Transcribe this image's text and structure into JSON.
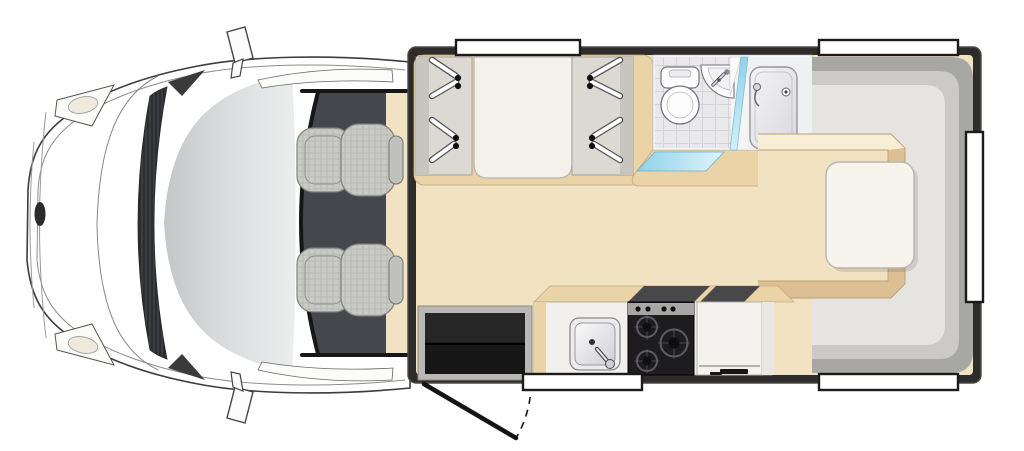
{
  "meta": {
    "description": "Top-down floor plan illustration of a motorhome (van cab at left, habitation area at right)",
    "view": "plan-view",
    "background": "#ffffff"
  },
  "colors": {
    "wall": "#2d2c2a",
    "wall_edge": "#4a4a48",
    "floor": "#f1e2c1",
    "bevel_light": "#f8eed5",
    "bevel_mid": "#e9d3a7",
    "bevel_dark": "#dcbf92",
    "cab_floor": "#45474c",
    "body": "#ffffff",
    "seat": "#c9c9c5",
    "headrest": "#c0c0bd",
    "lounge_back": "#a7a7a5",
    "lounge_mid": "#cbcac6",
    "lounge_cushion": "#e6e4e0",
    "table": "#f7f4ee",
    "bed": "#f4f1ea",
    "panel": "#dcd9d3",
    "panel_shadow": "#c8c5bf",
    "bathroom_floor": "#f5f5f6",
    "tile": "#e9e9ec",
    "shower_floor": "#eff0f2",
    "fixture": "#fdfdfe",
    "glass": "#9edcf1",
    "counter": "#f2f0ec",
    "stove": "#1d1d20",
    "knob_strip": "#a7a7a5",
    "worktop": "#48484b",
    "fridge": "#f4f2ee",
    "end_panel": "#e9e7e2",
    "entry_black": "#171717",
    "entry_frame": "#b9b8b5",
    "window_fill": "#ffffff",
    "window_border": "#1b1b1b"
  },
  "cab": {
    "label": "driver-cab",
    "seat_count": 2,
    "features": [
      "windshield",
      "hood",
      "grille",
      "headlight-top",
      "headlight-bottom",
      "front-badge",
      "side-mirror-top",
      "side-mirror-bottom",
      "door-window-top",
      "door-window-bottom"
    ]
  },
  "habitation": {
    "front_section": {
      "wardrobe_left_hangers": 4,
      "wardrobe_right_hangers": 4,
      "bed": "front-bunk"
    },
    "bathroom": {
      "fixtures": [
        "toilet",
        "corner-basin",
        "shower-tray"
      ],
      "glass_partition": true,
      "sliding_door": true,
      "floor": "tiled"
    },
    "kitchen": {
      "fixtures": [
        "sink-with-faucet",
        "stove",
        "dark-worktop",
        "fridge"
      ],
      "stove_burners": 3,
      "stove_knobs": 4
    },
    "rear_lounge": {
      "shape": "U-shaped-bench",
      "table": true,
      "raised_platform": true
    },
    "entry": {
      "type": "hinged-door",
      "swing_arc_shown": true
    },
    "windows": {
      "top": 2,
      "bottom": 2,
      "rear": 1,
      "total": 5
    }
  }
}
